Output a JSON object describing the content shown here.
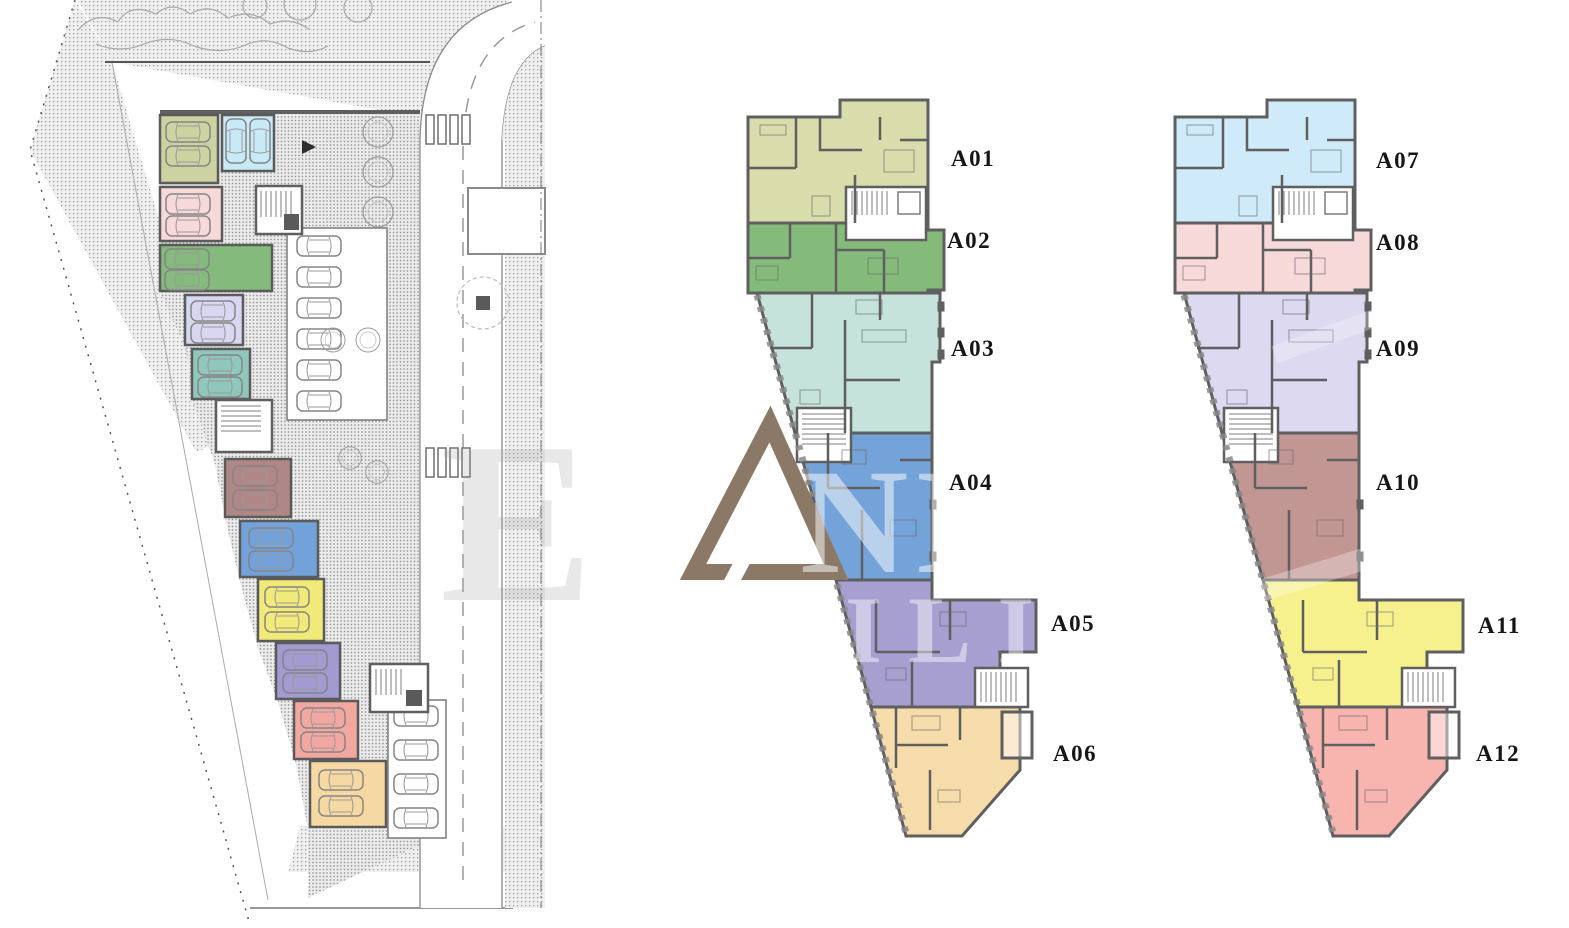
{
  "page": {
    "background": "#ffffff"
  },
  "site_plan": {
    "cars_per_garage": 2,
    "center_parking_spaces": 6,
    "bottom_parking_spaces": 4,
    "garages": [
      {
        "color": "#cdd3a0"
      },
      {
        "color": "#c8e9f6"
      },
      {
        "color": "#f8d9d9"
      },
      {
        "color": "#84ba7c"
      },
      {
        "color": "#d9d6f2"
      },
      {
        "color": "#8fc7bc"
      },
      {
        "color": "#b18686"
      },
      {
        "color": "#72a2d9"
      },
      {
        "color": "#f2ea78"
      },
      {
        "color": "#a29ad0"
      },
      {
        "color": "#f2a7a1"
      },
      {
        "color": "#f6d9a2"
      }
    ]
  },
  "floors": [
    {
      "units": [
        {
          "label": "A01",
          "color": "#d9dcab"
        },
        {
          "label": "A02",
          "color": "#84bb7b"
        },
        {
          "label": "A03",
          "color": "#c5e3da"
        },
        {
          "label": "A04",
          "color": "#74a3da"
        },
        {
          "label": "A05",
          "color": "#a79fd0"
        },
        {
          "label": "A06",
          "color": "#f7dcab"
        }
      ]
    },
    {
      "units": [
        {
          "label": "A07",
          "color": "#cfeaf8"
        },
        {
          "label": "A08",
          "color": "#f6d9d8"
        },
        {
          "label": "A09",
          "color": "#dcd9f0"
        },
        {
          "label": "A10",
          "color": "#c29693"
        },
        {
          "label": "A11",
          "color": "#f6f08d"
        },
        {
          "label": "A12",
          "color": "#f8b5b0"
        }
      ]
    }
  ],
  "watermark": {
    "triangle_color": "#8c7866",
    "letters": "NNI",
    "letters_row2": "ILI",
    "ghost_letter": "E"
  }
}
